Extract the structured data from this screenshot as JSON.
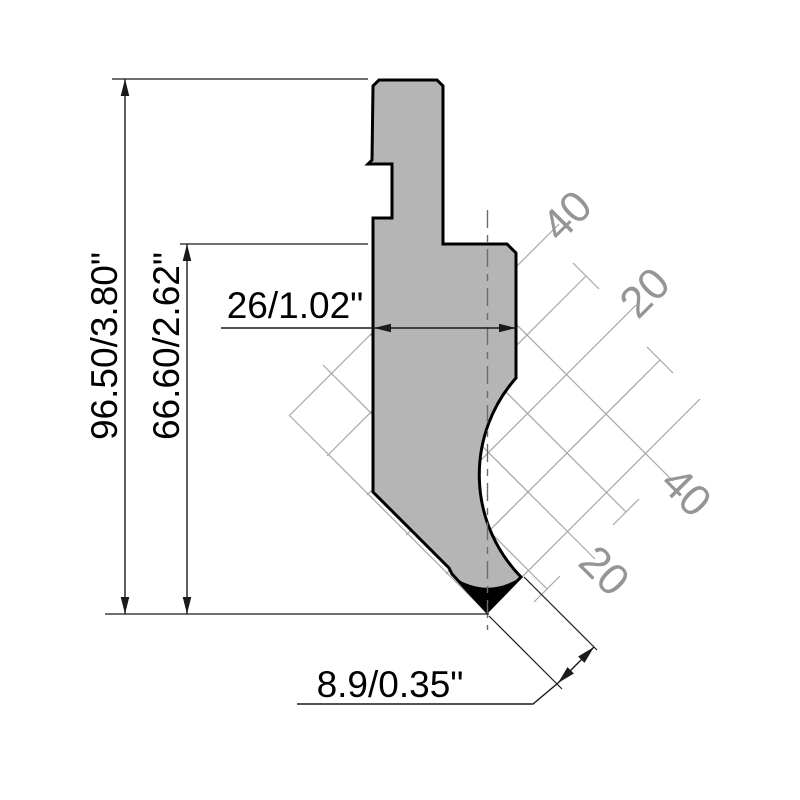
{
  "drawing": {
    "tool": "press-brake-punch-profile",
    "dims": {
      "overall_height": "96.50/3.80\"",
      "working_height": "66.60/2.62\"",
      "body_width": "26/1.02\"",
      "tip_flat": "8.9/0.35\""
    },
    "grid": {
      "labels": [
        "40",
        "20",
        "40",
        "20"
      ]
    },
    "colors": {
      "punch_fill": "#b5b5b5",
      "outline": "#000000",
      "grid_line": "#a6a6a6",
      "grid_label": "#959595",
      "dimension": "#1a1a1a"
    }
  }
}
